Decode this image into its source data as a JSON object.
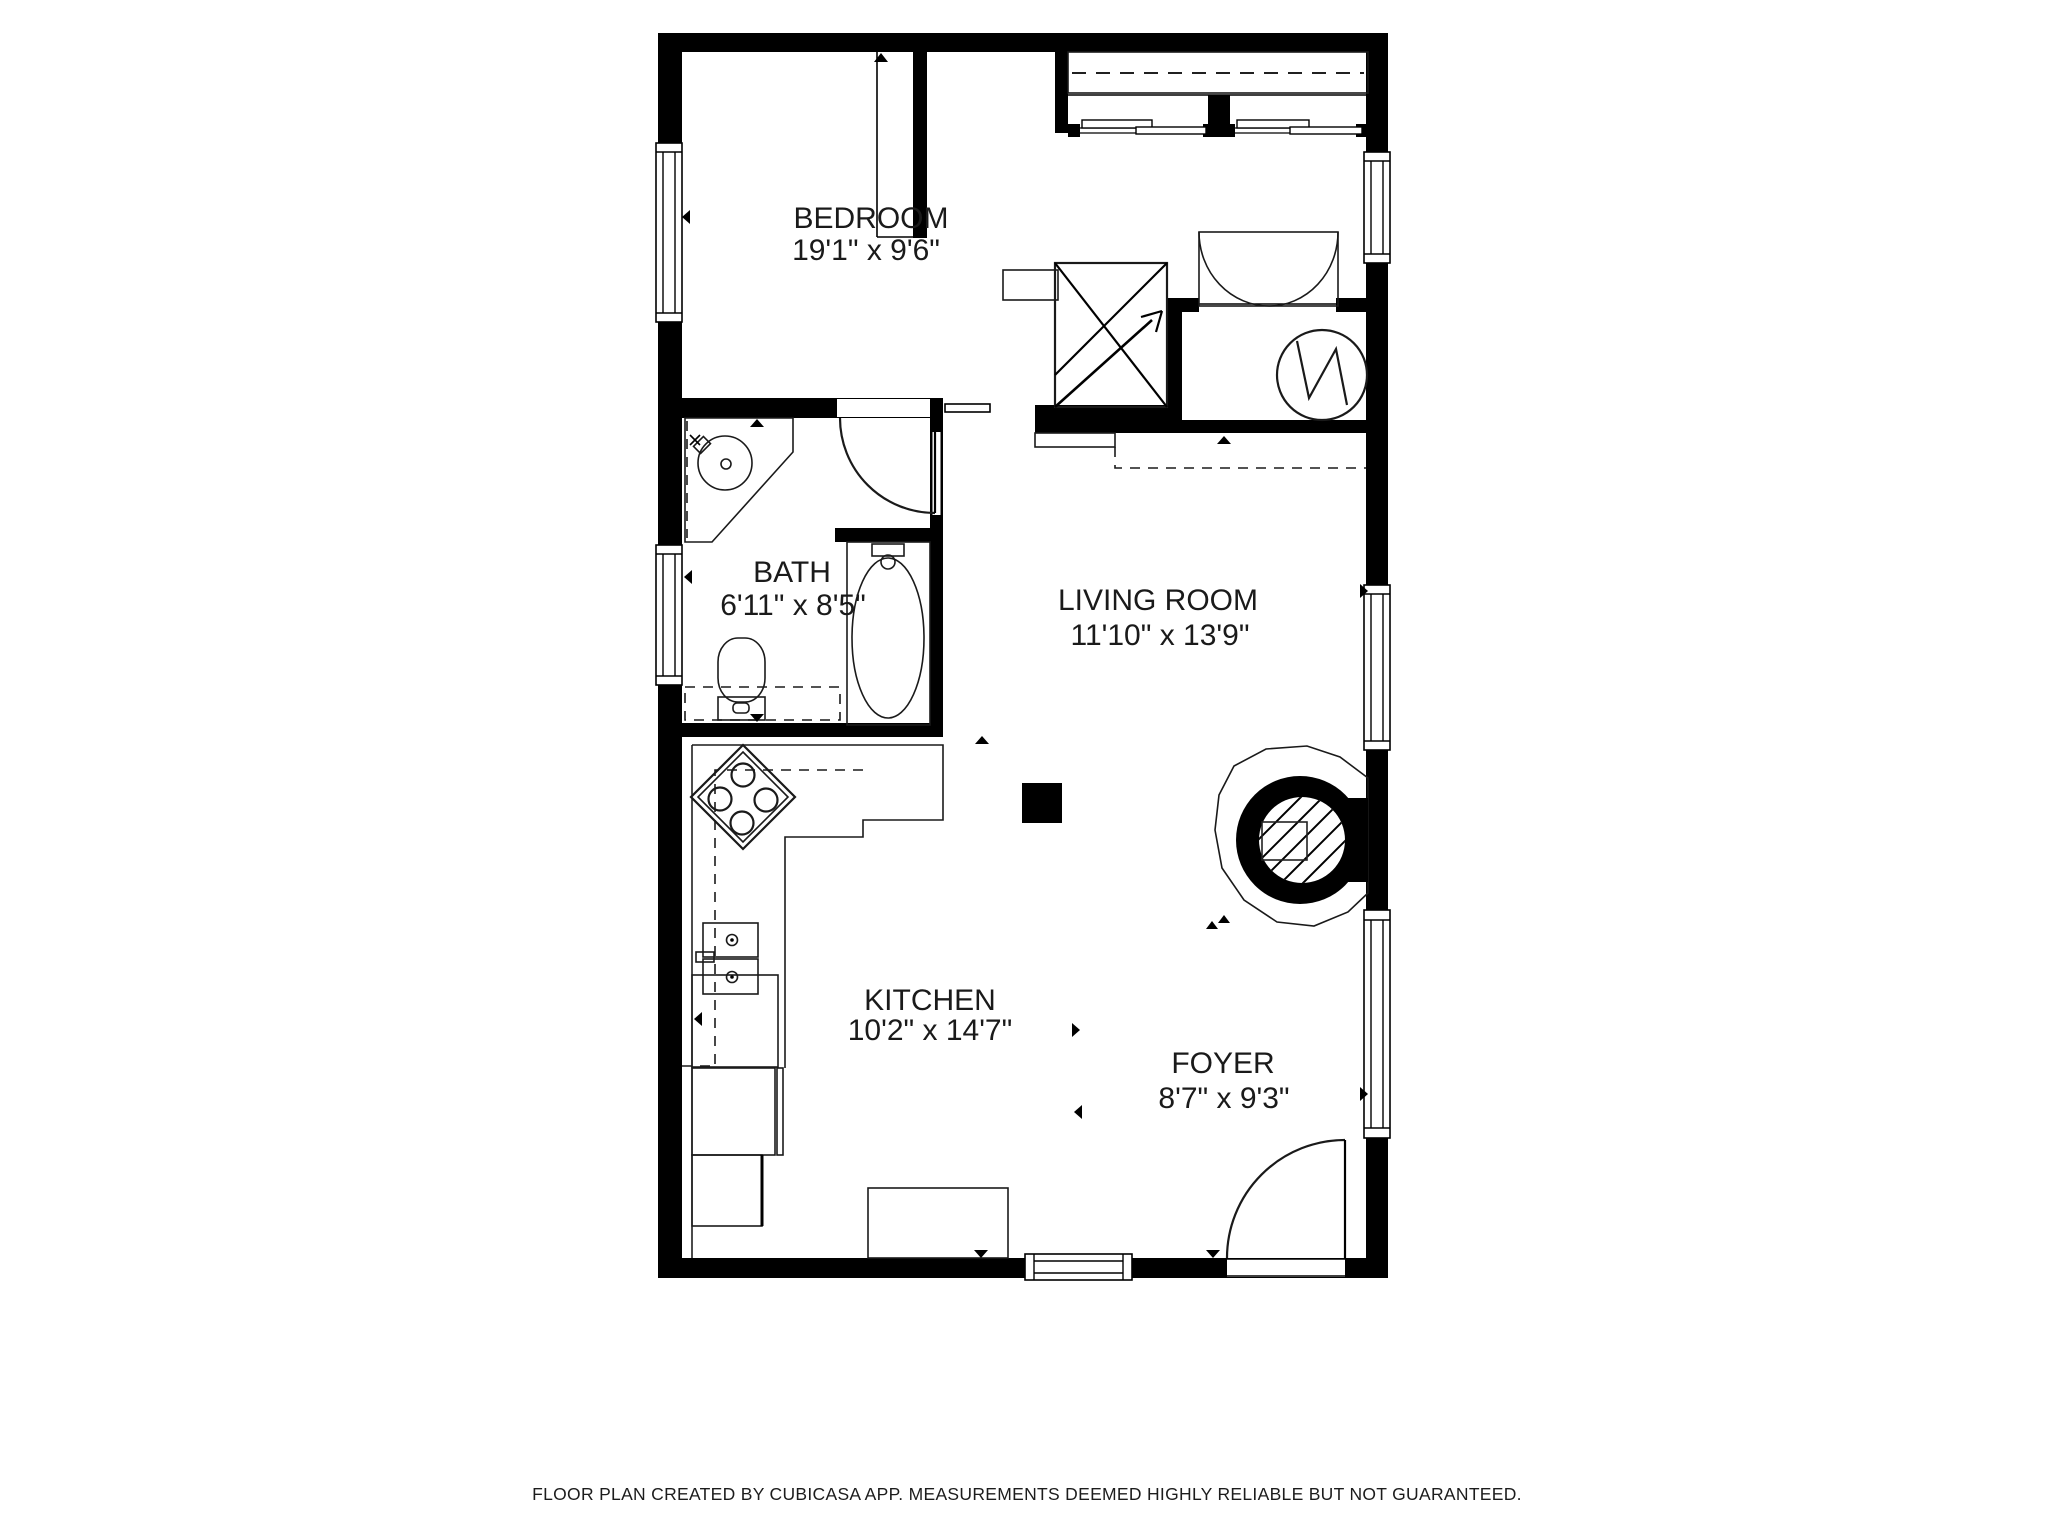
{
  "plan": {
    "app_credit": "CUBICASA",
    "rooms": [
      {
        "id": "bedroom",
        "name": "BEDROOM",
        "dimensions": "19'1\" x 9'6\""
      },
      {
        "id": "bath",
        "name": "BATH",
        "dimensions": "6'11\" x 8'5\""
      },
      {
        "id": "living-room",
        "name": "LIVING ROOM",
        "dimensions": "11'10\" x 13'9\""
      },
      {
        "id": "kitchen",
        "name": "KITCHEN",
        "dimensions": "10'2\" x 14'7\""
      },
      {
        "id": "foyer",
        "name": "FOYER",
        "dimensions": "8'7\" x 9'3\""
      }
    ],
    "symbols": {
      "window": "double-line glazing with end caps",
      "door": "quarter-arc swing",
      "pocket-door": "thin sliding leaf in wall gap",
      "double-closet-doors": "two quarter arcs in outlined box",
      "sliding-wardrobe": "rod dashed line + offset track leaves",
      "stairs-indicator": "crossed square with direction arrow",
      "water-heater": "circle with zigzag",
      "fireplace-stove": "hatched circle in black ring with hearth polygon",
      "stove": "rotated square with 4 burners",
      "kitchen-sink": "two basins with drains and faucet",
      "column": "filled black square",
      "measure-marker": "small black triangle"
    },
    "colors": {
      "wall": "#000000",
      "background": "#ffffff",
      "label_text": "#1a1a1a",
      "disclaimer_text": "#1c1c1c"
    }
  },
  "footer": {
    "disclaimer": "FLOOR PLAN CREATED BY CUBICASA APP. MEASUREMENTS DEEMED HIGHLY RELIABLE BUT NOT GUARANTEED."
  }
}
